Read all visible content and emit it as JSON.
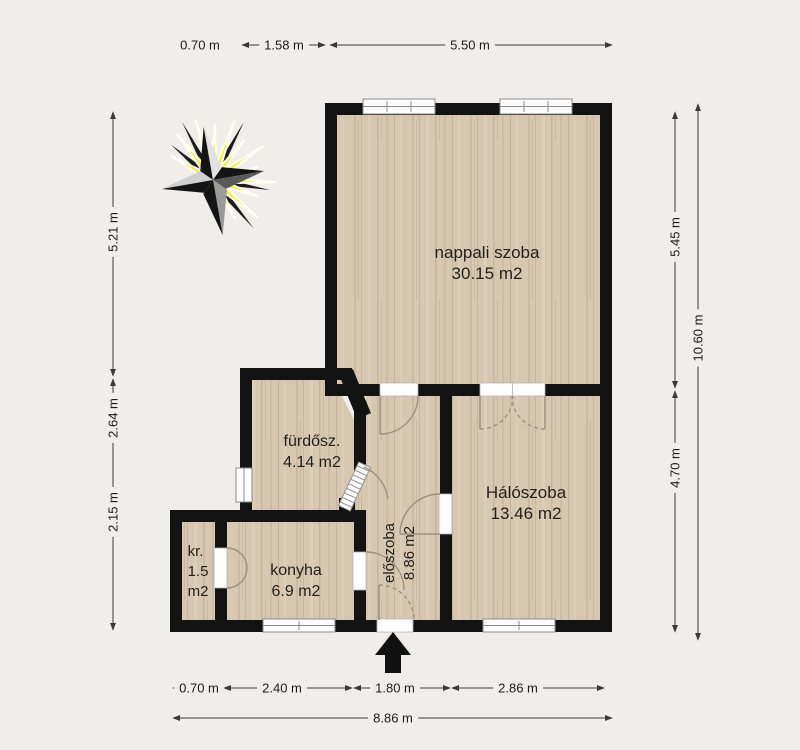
{
  "rooms": {
    "nappali": {
      "name": "nappali szoba",
      "area": "30.15 m2"
    },
    "furdosz": {
      "name": "fürdősz.",
      "area": "4.14 m2"
    },
    "haloszoba": {
      "name": "Hálószoba",
      "area": "13.46 m2"
    },
    "konyha": {
      "name": "konyha",
      "area": "6.9 m2"
    },
    "kr": {
      "name": "kr.",
      "area_value": "1.5",
      "area_unit": "m2"
    },
    "eloszoba": {
      "name": "előszoba",
      "area": "8.86 m2"
    }
  },
  "dimensions": {
    "top": [
      "0.70 m",
      "1.58 m",
      "5.50 m"
    ],
    "left": [
      "5.21 m",
      "2.64 m",
      "2.15 m"
    ],
    "right": [
      "5.45 m",
      "4.70 m",
      "10.60 m"
    ],
    "bottom": [
      "0.70 m",
      "2.40 m",
      "1.80 m",
      "2.86 m"
    ],
    "bottom_total": "8.86 m"
  },
  "icons": {
    "compass": "compass-sun-icon",
    "entrance": "entrance-arrow-icon"
  },
  "colors": {
    "wall": "#131313",
    "floor": "#d7c7b0",
    "sun_yellow": "#f6ee35",
    "background": "#f0eeea",
    "dimension_text": "#1c1c1c"
  }
}
